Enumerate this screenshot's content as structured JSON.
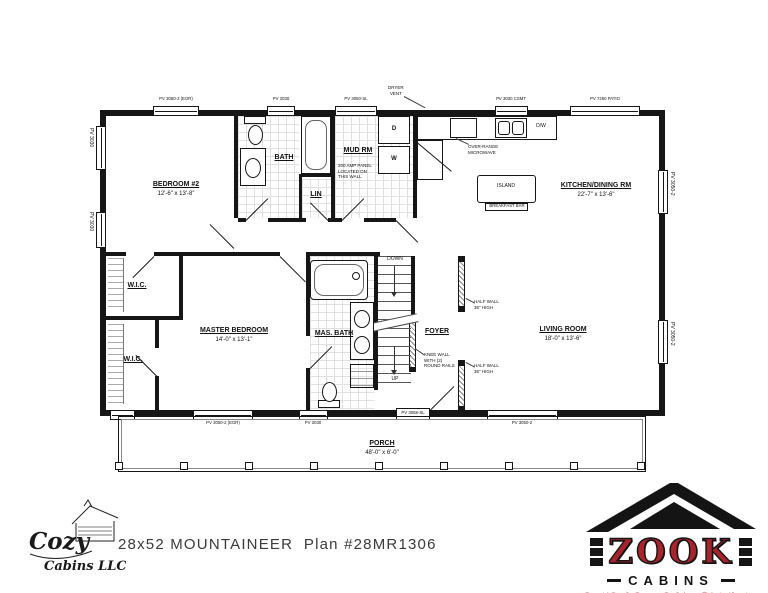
{
  "plan": {
    "rooms": {
      "bedroom2": {
        "name": "BEDROOM #2",
        "dims": "12'-6\" x 13'-8\""
      },
      "bath": {
        "name": "BATH"
      },
      "lin": {
        "name": "LIN"
      },
      "mud": {
        "name": "MUD RM"
      },
      "kitchen": {
        "name": "KITCHEN/DINING RM",
        "dims": "22'-7\" x 13'-6\""
      },
      "wic_upper": {
        "name": "W.I.C."
      },
      "wic_lower": {
        "name": "W.I.C."
      },
      "master": {
        "name": "MASTER BEDROOM",
        "dims": "14'-0\" x 13'-1\""
      },
      "masbath": {
        "name": "MAS. BATH"
      },
      "foyer": {
        "name": "FOYER"
      },
      "living": {
        "name": "LIVING ROOM",
        "dims": "18'-0\" x 13'-6\""
      },
      "porch": {
        "name": "PORCH",
        "dims": "48'-0\" x 6'-0\""
      }
    },
    "fixtures": {
      "island": "ISLAND",
      "breakfast_bar": "BREAKFAST BAR",
      "dishwasher": "D/W",
      "dryer": "D",
      "washer": "W",
      "stairs_down": "DOWN",
      "stairs_up": "UP"
    },
    "notes": {
      "dryer_vent": [
        "DRYER",
        "VENT"
      ],
      "microwave": [
        "OVER-RANGE",
        "MICROWAVE"
      ],
      "panel": [
        "200 AMP PANEL",
        "LOCATED ON",
        "THIS WALL"
      ],
      "half_wall_upper": [
        "HALF WALL",
        "36\" HIGH"
      ],
      "half_wall_lower": [
        "HALF WALL",
        "36\" HIGH"
      ],
      "knee_wall": [
        "KNEE WALL",
        "WITH (2)",
        "ROUND RAILS"
      ]
    },
    "openings": {
      "top_bedroom2": "PV 3050-2 (EGR)",
      "top_bath": "PV 3030",
      "top_mud_door": "PV 3050-SL",
      "top_kitchen": "PV 3030 CSMT",
      "top_patio": "PV 7260 PATIO",
      "left_upper": "PV 3030",
      "left_lower": "PV 3030",
      "right_upper": "PV 3050-2",
      "right_lower": "PV 3050-2",
      "bottom_master": "PV 3050-2 (EGR)",
      "bottom_masbath": "PV 3030",
      "bottom_entry": "PV 3068-SL",
      "bottom_living": "PV 3050-2"
    }
  },
  "footer": {
    "plan_title": "28x52 MOUNTAINEER  Plan #28MR1306",
    "cozy": {
      "line1": "Cozy",
      "line2": "Cabins LLC"
    },
    "zook": {
      "name": "ZOOK",
      "sub": "CABINS",
      "tagline": "Certified Cozy Cabins Distributor",
      "accent": "#a8242c"
    }
  }
}
